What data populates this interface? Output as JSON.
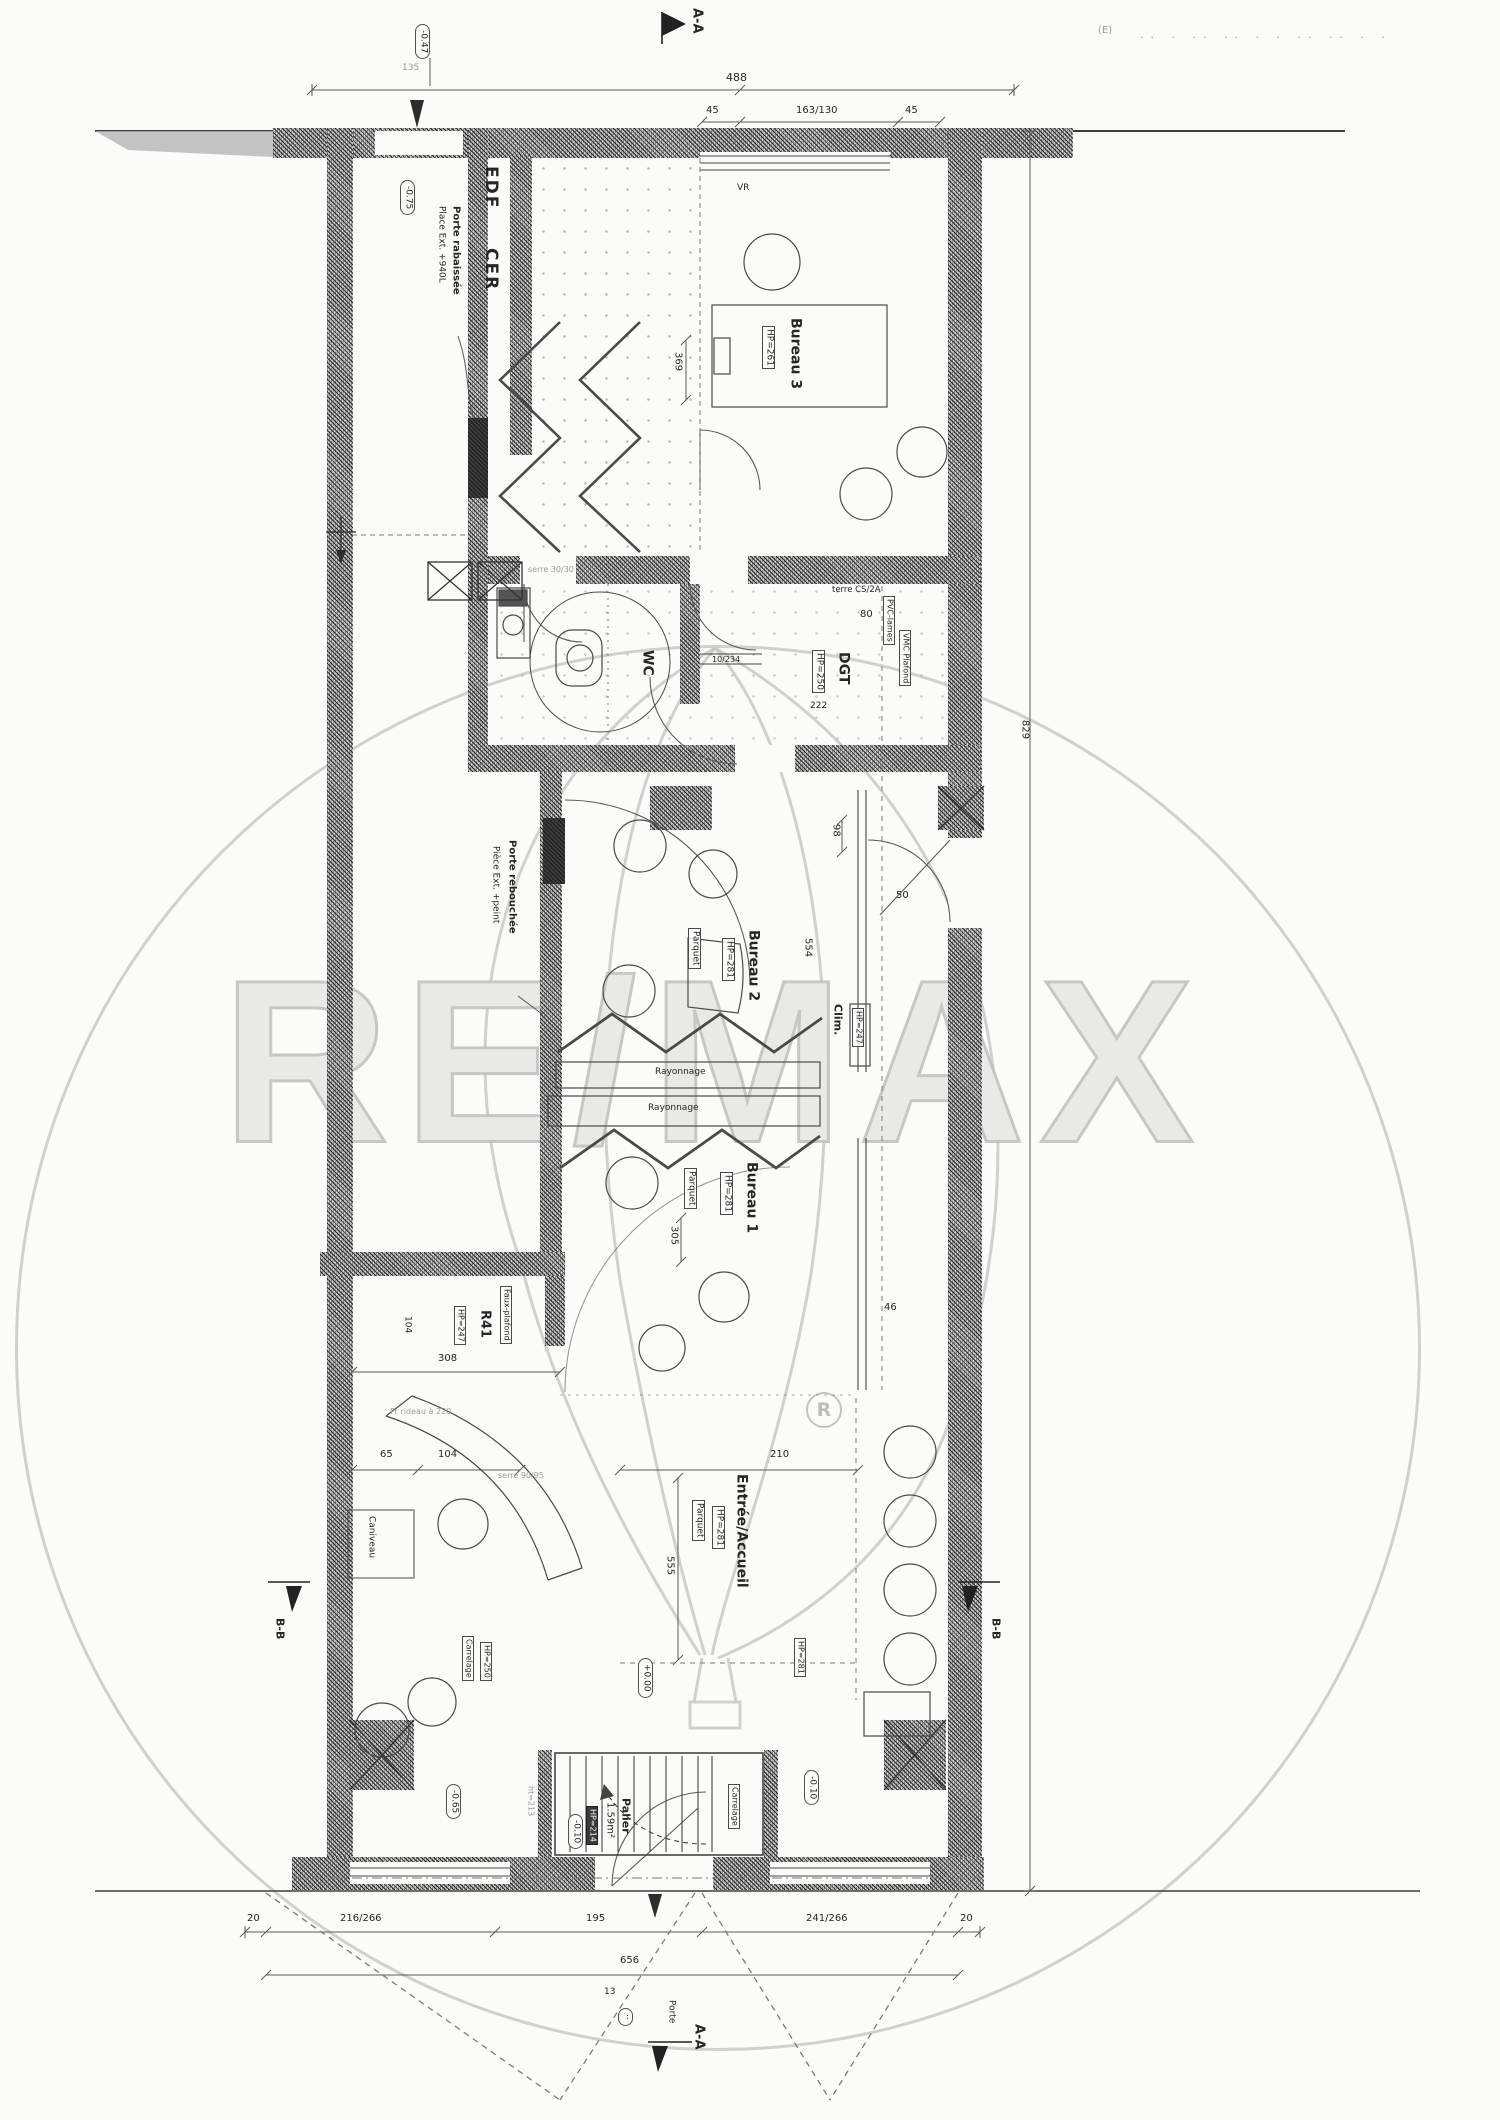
{
  "watermark": {
    "brand": "RE/MAX",
    "registered": "R"
  },
  "markers": {
    "aa": "A-A",
    "bb": "B-B",
    "e_mark": "(E)",
    "faint_row": "·· ·  ·· ··  · ·  ·· ··  · ·"
  },
  "levels": {
    "l1": "-0.47",
    "l2": "-0.75",
    "l3": "+0.00",
    "l4": "-0.65",
    "l5": "-0.10",
    "l6": "-0.10",
    "l7": "··"
  },
  "rooms": {
    "edf": "EDF",
    "cer": "CER",
    "vr": "VR",
    "bureau3": {
      "name": "Bureau 3",
      "hp": "HP=261"
    },
    "wc": {
      "name": "WC"
    },
    "dgt": {
      "name": "DGT",
      "hp": "HP=250",
      "note1": "PVC-lames",
      "note2": "VMC Plafond",
      "terre": "terre CS/2A"
    },
    "bureau2": {
      "name": "Bureau 2",
      "hp": "HP=281",
      "floor": "Parquet"
    },
    "clim": {
      "name": "Clim.",
      "hp": "HP=247"
    },
    "bureau1": {
      "name": "Bureau 1",
      "hp": "HP=281",
      "floor": "Parquet"
    },
    "r41": {
      "name": "R41",
      "hp": "HP=247",
      "note": "Faux-plafond"
    },
    "entree": {
      "name": "Entrée/Accueil",
      "hp": "HP=281",
      "floor": "Parquet"
    },
    "hall": {
      "hp": "HP=250",
      "floor": "Carrelage"
    },
    "right_room_hp": "HP=281",
    "palier": {
      "name": "Palier",
      "area": "1.59m²",
      "hp": "HP=214",
      "h": "ht=213",
      "floor": "Carrelage"
    },
    "rayonnage": "Rayonnage",
    "caniveau": "Caniveau"
  },
  "notes": {
    "porte_rabaissee_1": "Porte rabaissée",
    "porte_rabaissee_2": "Place Ext. +940L",
    "porte_rebouchee_1": "Porte rebouchée",
    "porte_rebouchee_2": "Pièce Ext. +peint",
    "rideau": "Pr rideau à 220",
    "serre": "serre 90/95",
    "serre2": "serre 30/30",
    "porte": "Porte"
  },
  "dims": {
    "total_width": "488",
    "w_left": "45",
    "w_mid": "163/130",
    "w_right": "45",
    "t135": "135",
    "total_height": "829",
    "d369": "369",
    "d222": "222",
    "d10_234": "10/234",
    "d80": "80",
    "d98": "98",
    "d50": "50",
    "d554": "554",
    "d46": "46",
    "d305": "305",
    "d308": "308",
    "d104": "104",
    "d65": "65",
    "d104b": "104",
    "d210": "210",
    "d555": "555",
    "b20l": "20",
    "b216": "216/266",
    "b195": "195",
    "b241": "241/266",
    "b20r": "20",
    "b656": "656",
    "b13": "13"
  }
}
